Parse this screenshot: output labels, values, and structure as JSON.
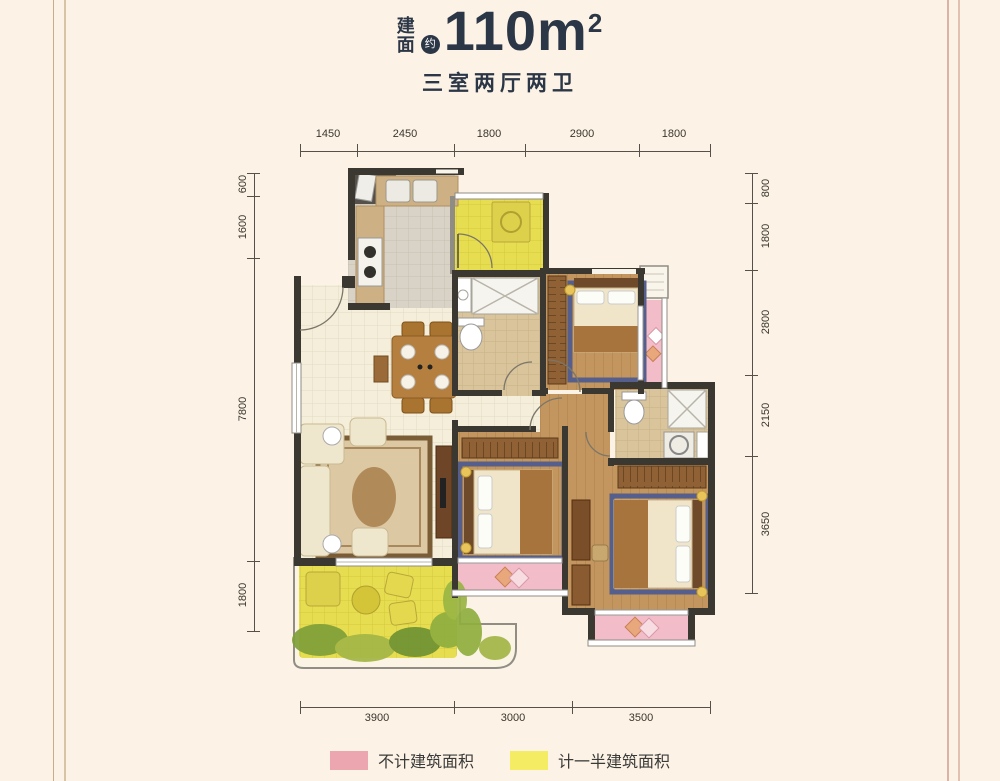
{
  "header": {
    "area_label_line1": "建",
    "area_label_line2": "面",
    "approx_badge": "约",
    "area_number": "110m",
    "area_exponent": "2",
    "subtitle": "三室两厅两卫"
  },
  "dimensions": {
    "top": [
      "1450",
      "2450",
      "1800",
      "2900",
      "1800"
    ],
    "bottom": [
      "3900",
      "3000",
      "3500"
    ],
    "left": [
      "600",
      "1600",
      "7800",
      "1800"
    ],
    "right": [
      "800",
      "1800",
      "2800",
      "2150",
      "3650"
    ]
  },
  "legend": {
    "items": [
      {
        "label": "不计建筑面积",
        "color": "#eba6b0"
      },
      {
        "label": "计一半建筑面积",
        "color": "#f4ec62"
      }
    ]
  },
  "colors": {
    "background": "#fcf3e6",
    "title_text": "#2b3646",
    "wall_dark": "#3b3832",
    "wall_gray": "#8f8c84",
    "balcony_yellow": "#e7dd50",
    "bay_window_pink": "#f2bdc8",
    "wood_floor": "#c2965e",
    "living_tile": "#f4eeda",
    "kitchen_tile": "#d8d3c6",
    "bath_tile": "#d9c49b"
  }
}
